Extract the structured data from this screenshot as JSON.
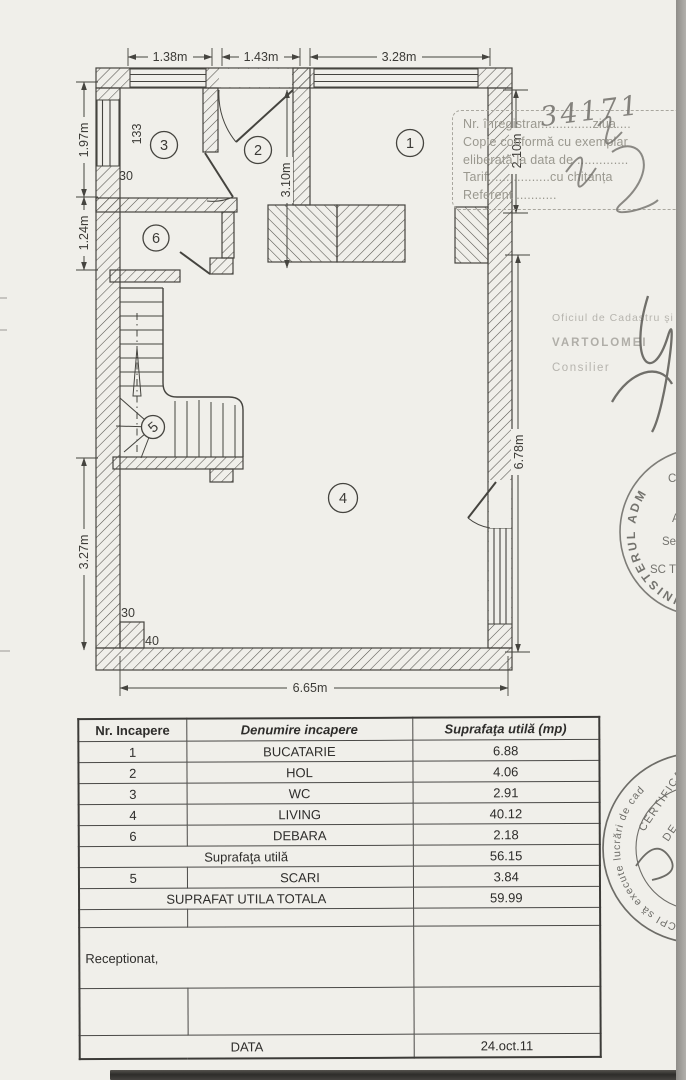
{
  "floor_plan": {
    "room_numbers": [
      "1",
      "2",
      "3",
      "4",
      "5",
      "6"
    ],
    "dims": {
      "top": [
        "1.38m",
        "1.43m",
        "3.28m"
      ],
      "left": [
        "1.97m",
        "1.24m",
        "3.27m"
      ],
      "right": [
        "2.10m",
        "6.78m"
      ],
      "interior": "3.10m",
      "bottom": "6.65m",
      "wall_marks": [
        "133",
        "30",
        "30",
        "40"
      ]
    }
  },
  "registration_stamp": {
    "lines": [
      "Nr. înregistrar..............ziua....",
      "Copie conformă cu exemplar",
      "eliberată la data de ..............",
      "Tarif.................cu chitanța",
      "Referent ..........."
    ],
    "handwritten_number": "34171"
  },
  "office_block": {
    "line1": "Oficiul de Cadastru şi",
    "line2": "VARTOLOMEI",
    "line3": "Consilier"
  },
  "round_stamp_top": {
    "rim": "MINISTERUL ADM",
    "inner": [
      "C",
      "A",
      "Se",
      "SC T"
    ]
  },
  "round_stamp_bottom": {
    "rim": "ANCPI să execute lucrări de cad",
    "inner1": "CERTIFICAT",
    "inner2": "DE"
  },
  "rooms_table": {
    "headers": [
      "Nr. Incapere",
      "Denumire incapere",
      "Suprafaţa utilă (mp)"
    ],
    "rows": [
      {
        "kind": "data",
        "nr": "1",
        "name": "BUCATARIE",
        "area": "6.88"
      },
      {
        "kind": "data",
        "nr": "2",
        "name": "HOL",
        "area": "4.06"
      },
      {
        "kind": "data",
        "nr": "3",
        "name": "WC",
        "area": "2.91"
      },
      {
        "kind": "data",
        "nr": "4",
        "name": "LIVING",
        "area": "40.12"
      },
      {
        "kind": "data",
        "nr": "6",
        "name": "DEBARA",
        "area": "2.18"
      },
      {
        "kind": "subtotal",
        "label": "Suprafaţa utilă",
        "area": "56.15"
      },
      {
        "kind": "data",
        "nr": "5",
        "name": "SCARI",
        "area": "3.84"
      },
      {
        "kind": "total",
        "label": "SUPRAFAT UTILA TOTALA",
        "area": "59.99"
      },
      {
        "kind": "empty_small"
      },
      {
        "kind": "reception",
        "label": "Receptionat,"
      },
      {
        "kind": "empty_large"
      },
      {
        "kind": "date",
        "label": "DATA",
        "area": "24.oct.11"
      }
    ]
  }
}
